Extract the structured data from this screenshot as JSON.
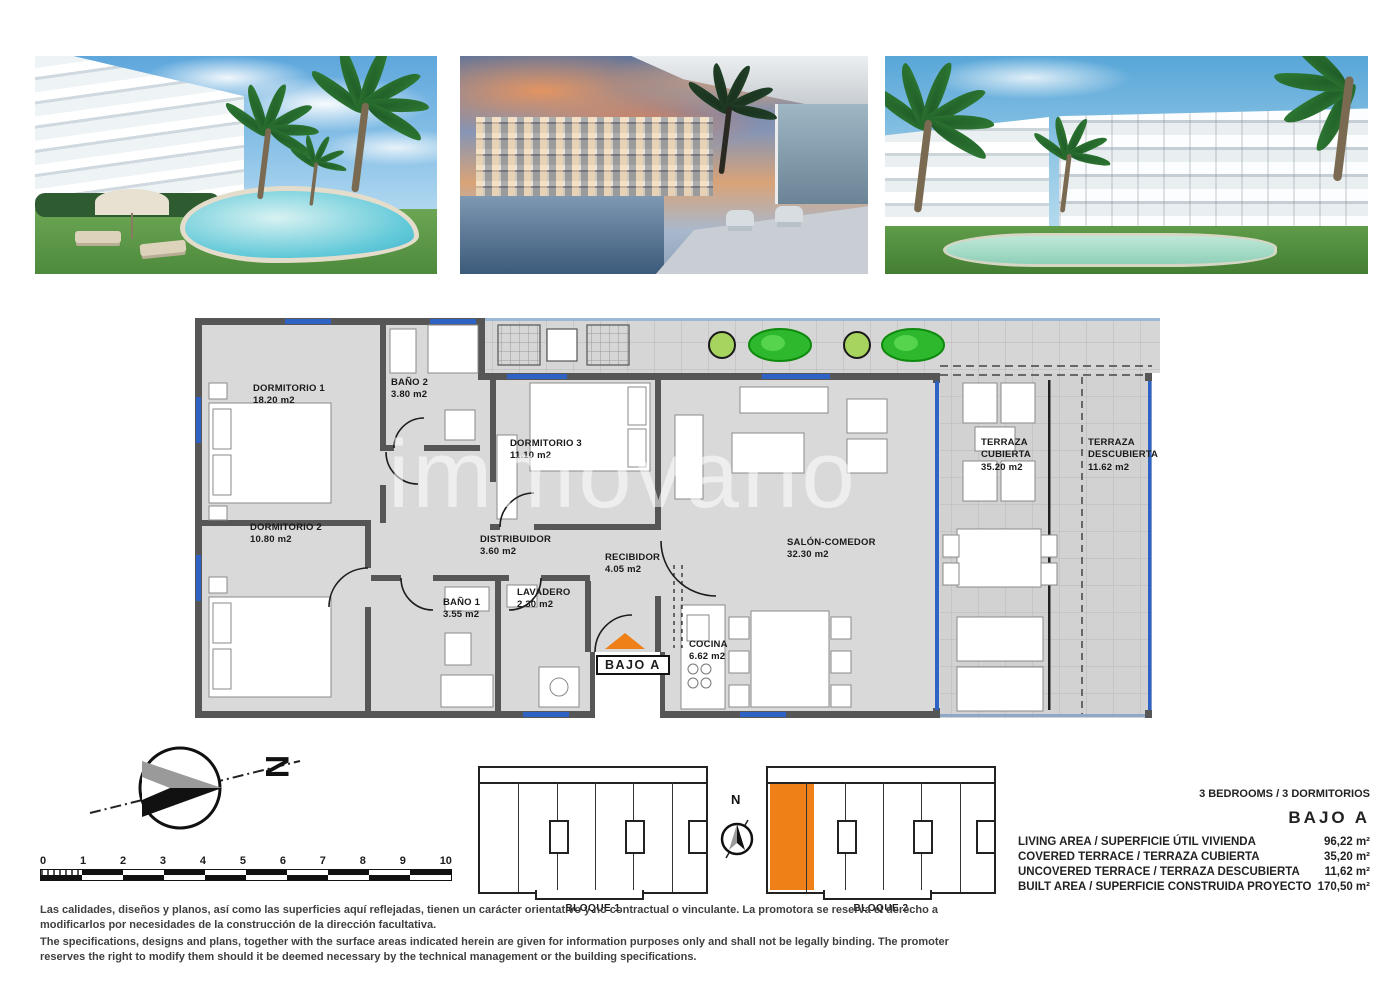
{
  "watermark": {
    "text": "immovario"
  },
  "photos": [
    {
      "name": "garden-pool-daytime-render"
    },
    {
      "name": "terrace-sunset-render"
    },
    {
      "name": "buildings-pool-daytime-render"
    }
  ],
  "floorplan": {
    "unit_box": "BAJO A",
    "rooms": [
      {
        "label": "DORMITORIO 1",
        "area": "18.20 m2"
      },
      {
        "label": "BAÑO 2",
        "area": "3.80 m2"
      },
      {
        "label": "DORMITORIO 3",
        "area": "11.10 m2"
      },
      {
        "label": "DORMITORIO 2",
        "area": "10.80 m2"
      },
      {
        "label": "DISTRIBUIDOR",
        "area": "3.60 m2"
      },
      {
        "label": "RECIBIDOR",
        "area": "4.05 m2"
      },
      {
        "label": "BAÑO 1",
        "area": "3.55 m2"
      },
      {
        "label": "LAVADERO",
        "area": "2.30 m2"
      },
      {
        "label": "SALÓN-COMEDOR",
        "area": "32.30 m2"
      },
      {
        "label": "COCINA",
        "area": "6.62 m2"
      },
      {
        "label": "TERRAZA CUBIERTA",
        "area": "35.20 m2"
      },
      {
        "label": "TERRAZA DESCUBIERTA",
        "area": "11.62 m2"
      }
    ]
  },
  "compass": {
    "north": "N"
  },
  "site": {
    "north": "N",
    "blocks": [
      {
        "label": "BLOQUE 1"
      },
      {
        "label": "BLOQUE 2"
      }
    ]
  },
  "scalebar": {
    "ticks": [
      "0",
      "1",
      "2",
      "3",
      "4",
      "5",
      "6",
      "7",
      "8",
      "9",
      "10"
    ]
  },
  "specs": {
    "type_line": "3 BEDROOMS / 3 DORMITORIOS",
    "unit": "BAJO A",
    "rows": [
      {
        "label": "LIVING AREA / SUPERFICIE ÚTIL VIVIENDA",
        "value": "96,22 m²"
      },
      {
        "label": "COVERED TERRACE / TERRAZA CUBIERTA",
        "value": "35,20 m²"
      },
      {
        "label": "UNCOVERED TERRACE / TERRAZA DESCUBIERTA",
        "value": "11,62 m²"
      },
      {
        "label": "BUILT AREA / SUPERFICIE CONSTRUIDA PROYECTO",
        "value": "170,50 m²"
      }
    ]
  },
  "disclaimer": {
    "es": "Las calidades, diseños y planos, así como las superficies aquí reflejadas, tienen un carácter orientativo y no contractual o vinculante. La promotora se reserva el derecho a modificarlos por necesidades de la construcción de la dirección facultativa.",
    "en": "The specifications, designs and plans, together with the surface areas indicated herein are given for information purposes only and shall not be legally binding. The promoter reserves the right to modify them should it be deemed necessary by the technical management or the building specifications."
  },
  "colors": {
    "accent_orange": "#EF8018",
    "window_blue": "#2E62C4",
    "wall_gray": "#565656",
    "plant_green": "#2DB82D",
    "plan_floor": "#D9D9D9"
  }
}
